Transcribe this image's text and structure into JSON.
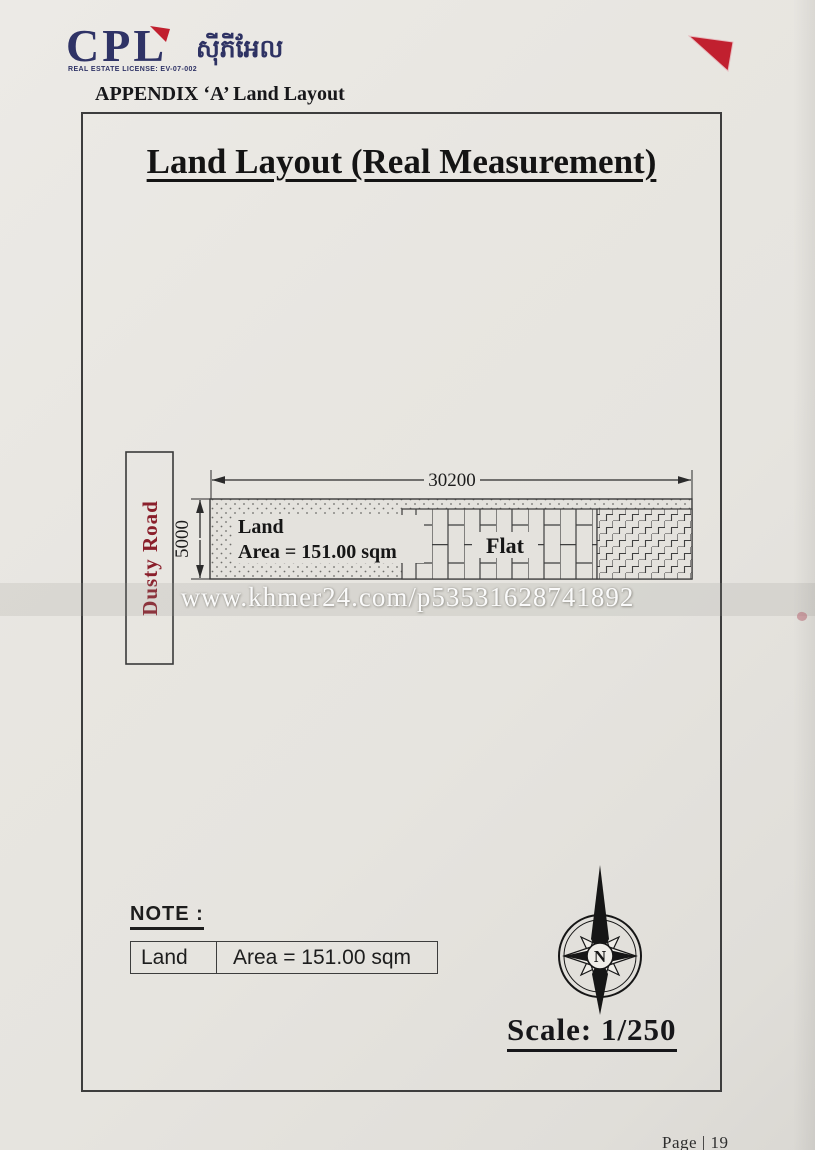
{
  "page": {
    "number": "Page | 19"
  },
  "header": {
    "logo_text": "CPL",
    "logo_license": "REAL ESTATE LICENSE: EV-07-002",
    "logo_khmer": "ស៊ីភីអែល",
    "appendix_heading": "APPENDIX ‘A’ Land Layout"
  },
  "sheet": {
    "title": "Land Layout (Real Measurement)",
    "diagram": {
      "road_label": "Dusty Road",
      "top_dimension": "30200",
      "left_dimension": "5000",
      "parcel_label": "Land",
      "parcel_area": "Area = 151.00 sqm",
      "building_label": "Flat"
    },
    "note_heading": "NOTE :",
    "note_table": {
      "col1": "Land",
      "col2": "Area = 151.00 sqm"
    },
    "compass_label": "N",
    "scale_label": "Scale: 1/250"
  },
  "watermark": "www.khmer24.com/p53531628741892",
  "colors": {
    "navy": "#2f3366",
    "red": "#c1202f",
    "road_red": "#8a1f2b"
  }
}
